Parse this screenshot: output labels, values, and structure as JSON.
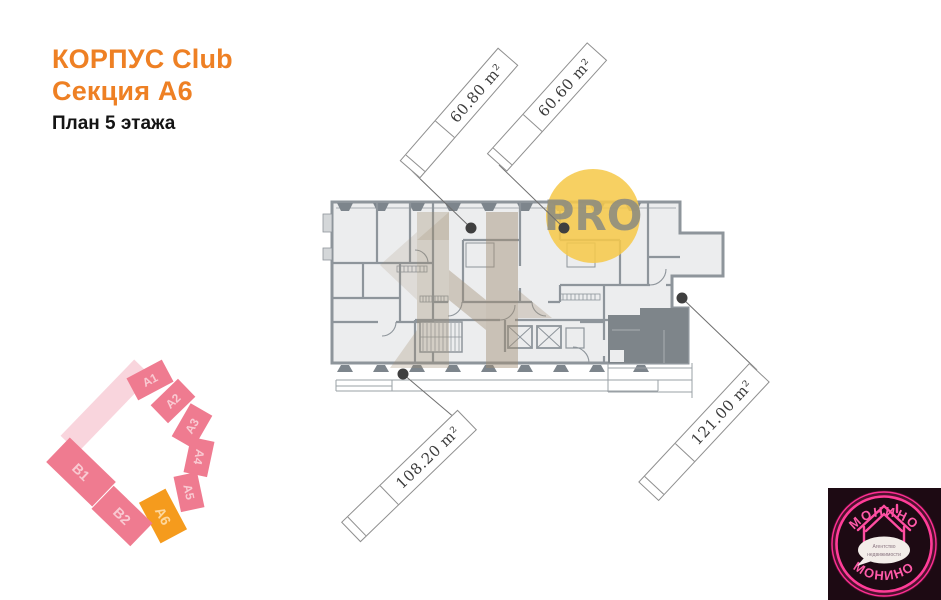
{
  "header": {
    "building_line": "КОРПУС Club",
    "section_line": "Секция А6",
    "floor_line": "План 5 этажа"
  },
  "pro_badge": {
    "label": "PRO"
  },
  "plan": {
    "units": [
      {
        "area": "60.80 m²"
      },
      {
        "area": "60.60 m²"
      },
      {
        "area": "108.20 m²"
      },
      {
        "area": "121.00 m²"
      }
    ]
  },
  "masterplan": {
    "highlighted": "А6",
    "sections": [
      {
        "label": "А1"
      },
      {
        "label": "А2"
      },
      {
        "label": "А3"
      },
      {
        "label": "А4"
      },
      {
        "label": "А5"
      },
      {
        "label": "А6"
      },
      {
        "label": "B1"
      },
      {
        "label": "B2"
      }
    ]
  },
  "logo": {
    "arc_top": "МОНИНО",
    "arc_bottom": "МОНИНО",
    "tagline_line1": "Агентство",
    "tagline_line2": "недвижимости"
  },
  "colors": {
    "accent_orange": "#ee8024",
    "section_pink": "#ef7b90",
    "section_orange": "#f59b1d",
    "pro_yellow": "#f6c94b",
    "logo_pink": "#ff3d98",
    "wall_gray": "#8e959b"
  }
}
